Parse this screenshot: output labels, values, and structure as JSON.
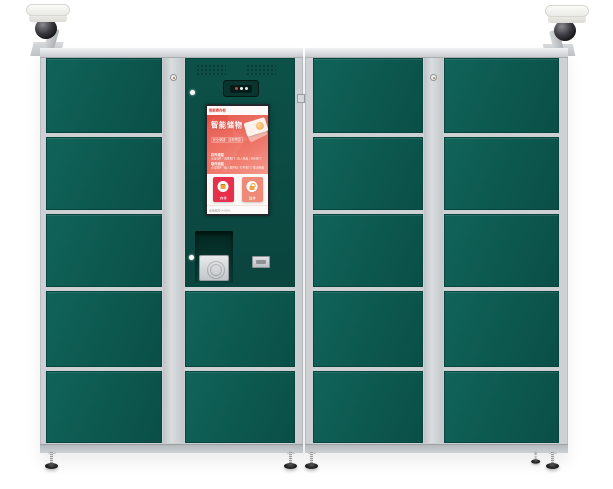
{
  "app": {
    "name": "智能寄存柜"
  },
  "colors": {
    "door_green": "#0d5a51",
    "panel_green": "#0b4c44",
    "frame_silver": "#cdd1d4",
    "banner_red": "#e85a4e",
    "deposit_red": "#e62f4b",
    "pickup_salmon": "#f08a78",
    "tip_orange": "#e06a3a",
    "camera_led_white": "#ffffff",
    "camera_led_red": "#c34a42"
  },
  "cabinet": {
    "door_rows": 5,
    "left_unit_door_count": 7,
    "right_unit_door_count": 10
  },
  "screen": {
    "header": {
      "brand": "智能寄存柜",
      "info": "自助服务 24小时"
    },
    "banner": {
      "title": "智能储物",
      "badge": "安全便捷 · 自助寄存",
      "sections": [
        {
          "heading": "存件流程",
          "items": "点击存件 / 选择柜门 / 存入物品 / 关好柜门"
        },
        {
          "heading": "取件流程",
          "items": "点击取件 / 输入取件码 / 打开柜门 / 取出物品"
        }
      ]
    },
    "actions": [
      {
        "label": "存件"
      },
      {
        "label": "取件"
      }
    ],
    "tip": "请选择存件或取件，开始使用吧！",
    "footer": {
      "left": "设备编号 A-0001",
      "right": "客服热线"
    }
  }
}
